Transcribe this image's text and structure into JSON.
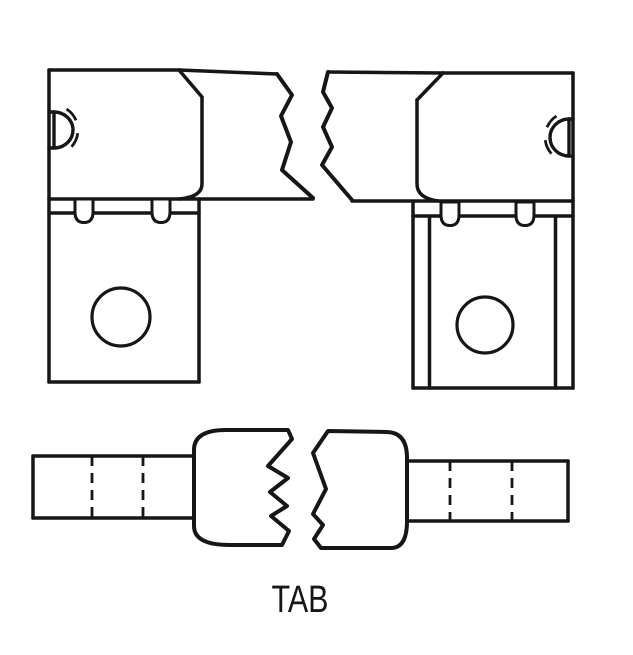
{
  "figure": {
    "caption": "TAB",
    "line_color": "#161616",
    "background_color": "#ffffff"
  }
}
